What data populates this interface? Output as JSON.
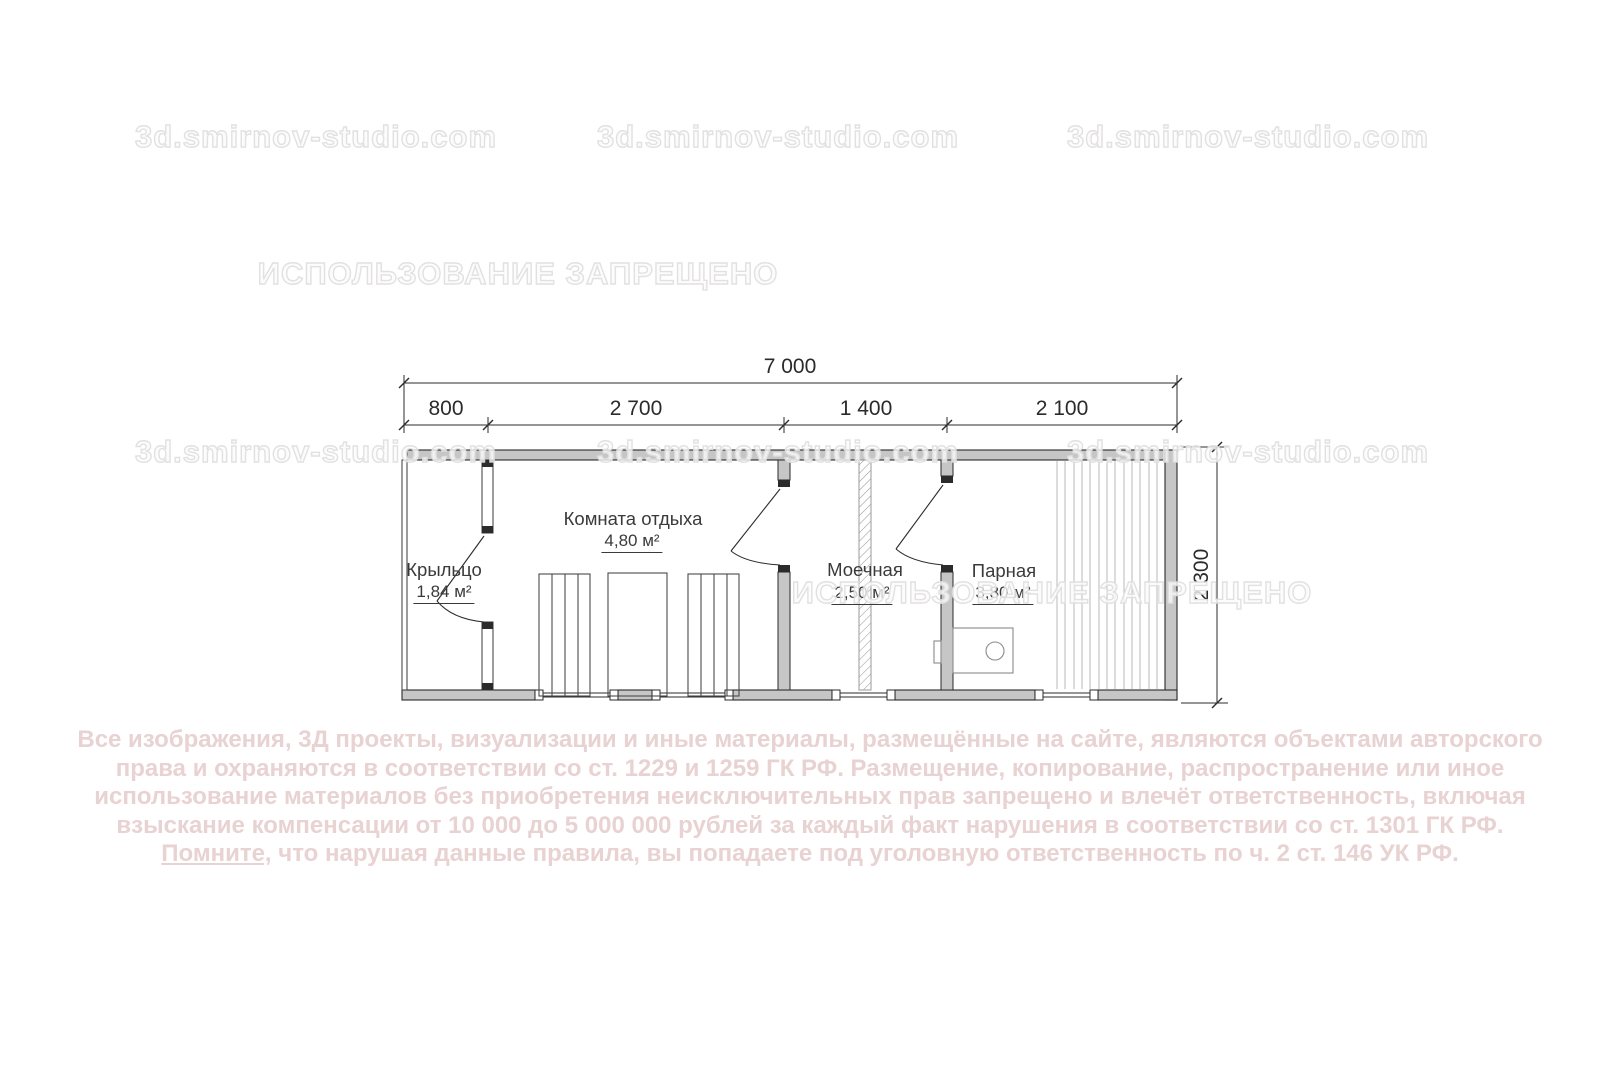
{
  "watermarks": {
    "site": "3d.smirnov-studio.com",
    "forbidden": "ИСПОЛЬЗОВАНИЕ ЗАПРЕЩЕНО"
  },
  "plan": {
    "dimensions": {
      "total_width": "7 000",
      "segments": [
        "800",
        "2 700",
        "1 400",
        "2 100"
      ],
      "height": "2 300"
    },
    "rooms": [
      {
        "name": "Крыльцо",
        "area": "1,84 м²"
      },
      {
        "name": "Комната отдыха",
        "area": "4,80 м²"
      },
      {
        "name": "Моечная",
        "area": "2,50 м²"
      },
      {
        "name": "Парная",
        "area": "3,80 м²"
      }
    ]
  },
  "copyright": {
    "line1": "Все изображения, 3Д проекты, визуализации и иные материалы, размещённые на сайте, являются объектами авторского",
    "line2": "права и охраняются в соответствии со ст. 1229 и 1259 ГК РФ. Размещение, копирование, распространение или иное",
    "line3": "использование материалов без приобретения неисключительных прав запрещено и влечёт ответственность, включая",
    "line4": "взыскание компенсации от 10 000 до 5 000 000 рублей за каждый факт нарушения в соответствии со ст. 1301 ГК РФ.",
    "line5_underlined": "Помните,",
    "line5_rest": " что нарушая данные правила, вы попадаете под уголовную ответственность по ч. 2 ст. 146 УК РФ."
  },
  "colors": {
    "wall_fill": "#c6c6c6",
    "line": "#2b2b2b",
    "copyright_pink": "#e8d2d2",
    "watermark_gray": "#e0e0e0"
  }
}
